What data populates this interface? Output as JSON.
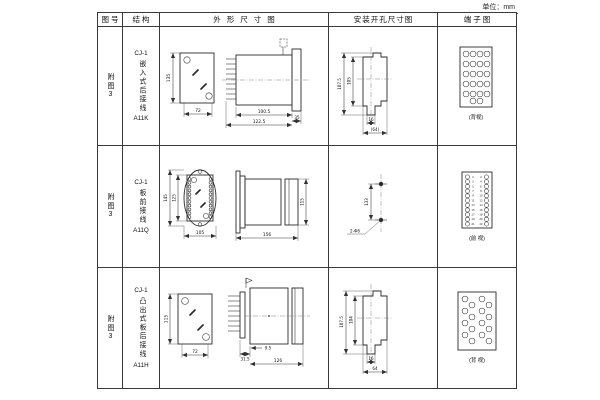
{
  "unit_label": "单位：mm",
  "table": {
    "headers": [
      "图号",
      "结构",
      "外形尺寸图",
      "安装开孔尺寸图",
      "端子图"
    ],
    "rows": [
      {
        "figure_no": "附图3",
        "structure": {
          "model": "CJ-1",
          "type": "嵌入式后接线",
          "code": "A11K"
        },
        "outline": {
          "front_height": "135",
          "front_width": "72",
          "side_body": "100.5",
          "side_total": "122.5",
          "side_flange": "35"
        },
        "mounting": {
          "outer_height": "107.5",
          "inner_height": "105",
          "slot_width": "16",
          "outer_width": "(64)"
        },
        "terminal": {
          "caption": "(背视)"
        }
      },
      {
        "figure_no": "附图3",
        "structure": {
          "model": "CJ-1",
          "type": "板前接线",
          "code": "A11Q"
        },
        "outline": {
          "front_height": "145",
          "front_inner_height": "125",
          "front_width": "105",
          "side_length": "156",
          "side_height": "115"
        },
        "mounting": {
          "hole_spacing": "133",
          "hole_spec": "2-Φ6"
        },
        "terminal": {
          "caption": "(前 视)",
          "numbers": [
            "1",
            "2",
            "3",
            "4",
            "5",
            "6",
            "7",
            "8",
            "9",
            "10",
            "11",
            "12",
            "13",
            "14",
            "15",
            "16",
            "17",
            "18",
            "19",
            "20",
            "21",
            "22"
          ]
        }
      },
      {
        "figure_no": "附图3",
        "structure": {
          "model": "CJ-1",
          "type": "凸出式板后接线",
          "code": "A11H"
        },
        "outline": {
          "front_height": "115",
          "front_width": "72",
          "side_pin_depth": "31.5",
          "side_offset": "9.5",
          "side_length": "126"
        },
        "mounting": {
          "outer_height": "107.5",
          "inner_height": "104",
          "slot_width": "16",
          "outer_width": "64"
        },
        "terminal": {
          "caption": "(背 视)"
        }
      }
    ]
  }
}
